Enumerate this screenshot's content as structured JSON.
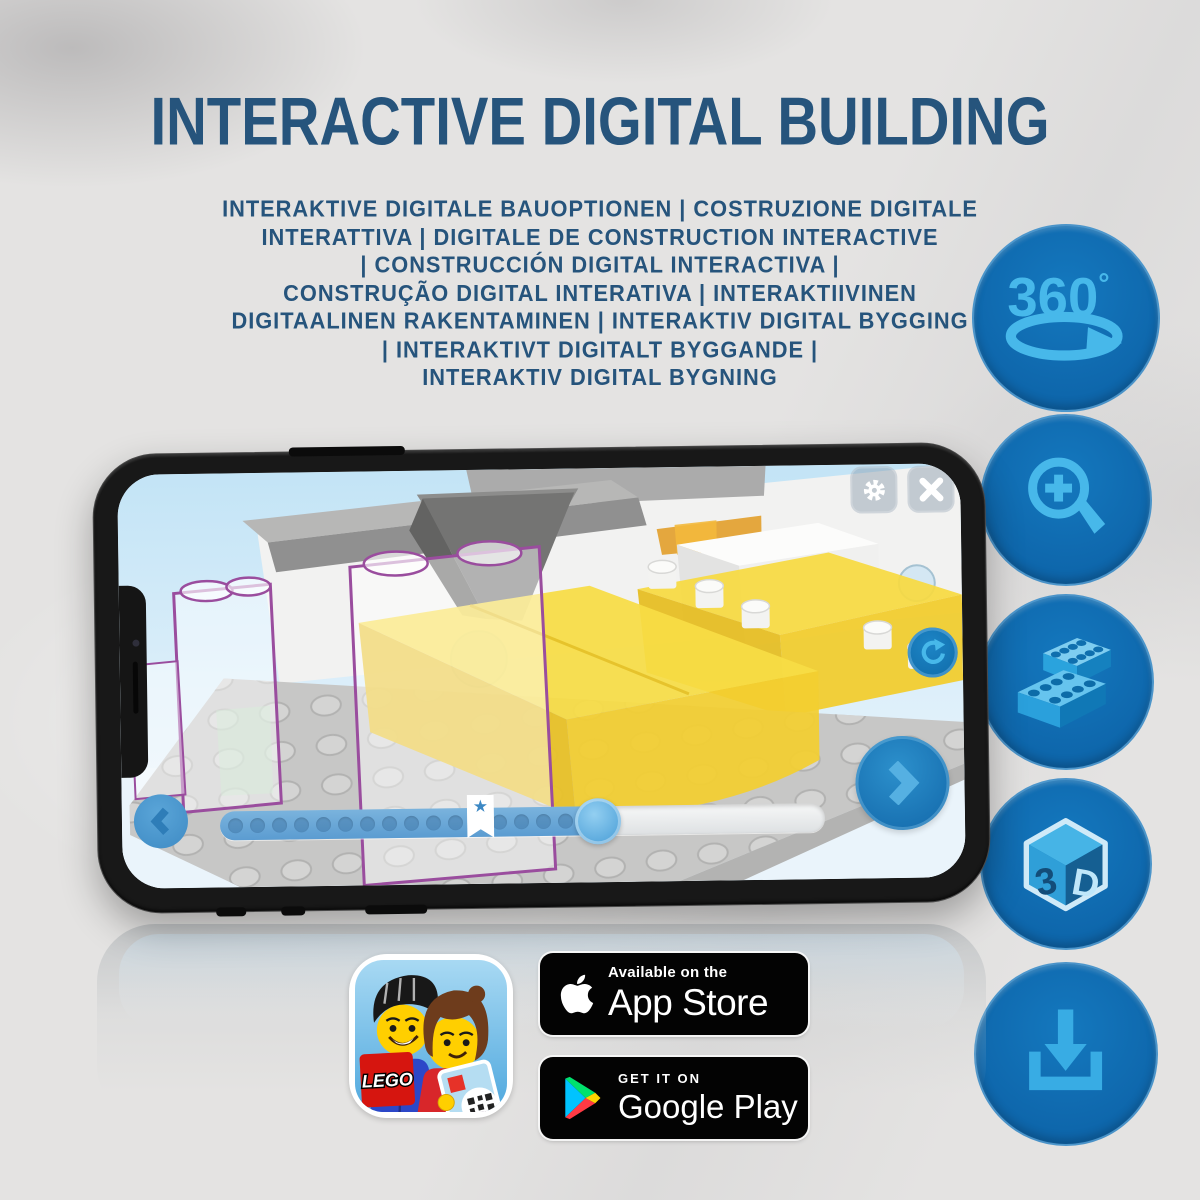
{
  "header": {
    "title": "INTERACTIVE DIGITAL BUILDING",
    "subtitle": "INTERAKTIVE DIGITALE BAUOPTIONEN | COSTRUZIONE DIGITALE\nINTERATTIVA | DIGITALE DE CONSTRUCTION INTERACTIVE\n| CONSTRUCCIÓN DIGITAL INTERACTIVA |\nCONSTRUÇÃO DIGITAL INTERATIVA | INTERAKTIIVINEN\nDIGITAALINEN RAKENTAMINEN | INTERAKTIV DIGITAL BYGGING\n| INTERAKTIVT DIGITALT BYGGANDE |\nINTERAKTIV DIGITAL BYGNING"
  },
  "feature_icons": [
    {
      "name": "360-rotation",
      "label": "360",
      "degree": "°"
    },
    {
      "name": "zoom-in"
    },
    {
      "name": "stacked-bricks"
    },
    {
      "name": "3d-view",
      "face_left": "3",
      "face_right": "D"
    },
    {
      "name": "download"
    }
  ],
  "phone_app": {
    "slider": {
      "progress_percent": 62.5,
      "bookmark_percent": 43,
      "dot_count": 17
    }
  },
  "glyphs": {
    "star": "★"
  },
  "badges": {
    "app_store": {
      "line1": "Available on the",
      "line2": "App Store"
    },
    "google_play": {
      "line1": "GET IT ON",
      "line2": "Google Play"
    },
    "app_icon_logo": "LEGO"
  },
  "colors": {
    "title_blue": "#26547C",
    "icon_circle_blue": "#0E66AB",
    "icon_glyph_blue": "#47B8EA",
    "app_ui_blue": "#5B9CD1",
    "lego_yellow": "#F3CF30",
    "lego_red": "#D6150F",
    "ghost_outline_purple": "#9A4D9E"
  }
}
